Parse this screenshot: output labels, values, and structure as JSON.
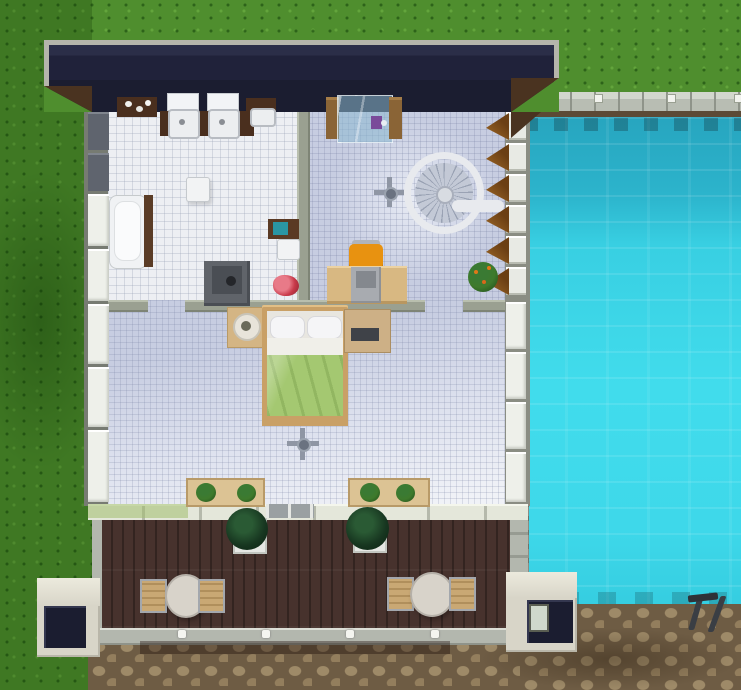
{
  "scene": {
    "description": "top-down life-sim game view of a modern house with bathroom, study landing with spiral staircase, bedroom, wooden deck and large swimming pool",
    "rooms": [
      {
        "name": "bathroom"
      },
      {
        "name": "study-landing"
      },
      {
        "name": "bedroom"
      },
      {
        "name": "deck"
      },
      {
        "name": "pool"
      }
    ],
    "objects": [
      "double-sink-vanity",
      "mirrors",
      "bathtub",
      "modern-toilet",
      "wall-shelf",
      "towel",
      "clothes-pile",
      "glass-shower",
      "spiral-staircase",
      "ceiling-fan",
      "computer-desk",
      "office-chair",
      "potted-plant",
      "double-bed",
      "nightstand-lamp",
      "dresser-stereo",
      "window-planter-boxes",
      "topiary-pots",
      "round-patio-tables",
      "patio-chairs",
      "deck-railing",
      "pool-ladder",
      "awning-windows",
      "porch-columns"
    ]
  },
  "colors": {
    "grass": "#4f8e2e",
    "roof": "#1b1d30",
    "roofTrim": "#b5b5ab",
    "roofSlope": "#4a3320",
    "wall": "#9aa091",
    "windowPane": "#eef0ea",
    "windowDark": "#5f646e",
    "tileWhite": "#edeff3",
    "tileLavender": "#c7cde1",
    "deck": "#47322d",
    "deckTrim": "#b3b7ae",
    "pavementStone": "#9e8a68",
    "poolWater": "#3bd4e6",
    "poolShadow": "#27a5bf",
    "coping": "#b8bdb3",
    "waterline": "#5c4a36",
    "porch": "#d8d5c8",
    "sillc": "#e4e7da",
    "wood": "#d8b882",
    "woodDark": "#4a2f1e",
    "bedGreen": "#a4c871",
    "linen": "#f2f3f4",
    "chairOrange": "#e89210",
    "chairTan": "#c9a874",
    "tableTop": "#d8d3ca",
    "bushDark": "#173620",
    "plantGreen": "#3e7a2c",
    "teal": "#2a96a4",
    "clothes": "#c83a4a",
    "metal": "#3a3e44",
    "applianceGray": "#60646a"
  }
}
